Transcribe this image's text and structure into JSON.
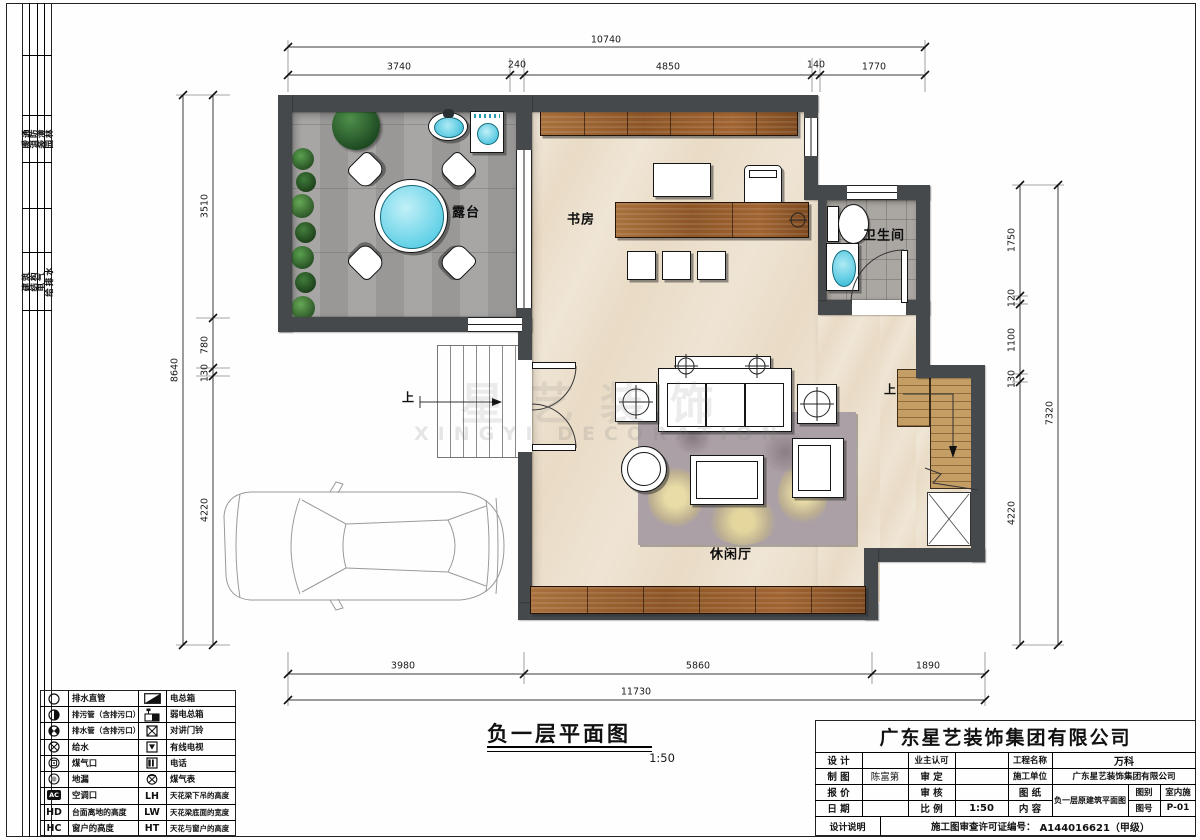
{
  "sidebar": {
    "group1": [
      "暖通",
      "消防",
      "装潢",
      "园林"
    ],
    "group2": [
      "建筑",
      "结构",
      "电气",
      "给排水"
    ]
  },
  "plan": {
    "rooms": {
      "terrace": "露台",
      "study": "书房",
      "bathroom": "卫生间",
      "lounge": "休闲厅"
    },
    "stair_up_left": "上",
    "stair_up_right": "上"
  },
  "watermark": {
    "cn": "星艺装饰",
    "en": "XINGYI DECORATION"
  },
  "dimensions": {
    "top": {
      "total": "10740",
      "segments": [
        "3740",
        "240",
        "4850",
        "140",
        "1770"
      ]
    },
    "bottom": {
      "total": "11730",
      "segments": [
        "3980",
        "5860",
        "1890"
      ]
    },
    "left": {
      "total": "8640",
      "segments": [
        "3510",
        "780",
        "130",
        "4220"
      ]
    },
    "right": {
      "total": "7320",
      "segments": [
        "1750",
        "120",
        "1100",
        "130",
        "4220"
      ]
    }
  },
  "plan_title": {
    "text": "负一层平面图",
    "scale": "1:50"
  },
  "legend": {
    "left": [
      {
        "label": "排水直管"
      },
      {
        "label": "排污管（含排污口）"
      },
      {
        "label": "排水管（含排污口）"
      },
      {
        "label": "给水"
      },
      {
        "label": "煤气口"
      },
      {
        "label": "地漏"
      },
      {
        "label": "空调口",
        "code": "AC"
      },
      {
        "label": "台面离地的高度",
        "code": "HD"
      },
      {
        "label": "窗户的高度",
        "code": "HC"
      }
    ],
    "right": [
      {
        "label": "电总箱"
      },
      {
        "label": "弱电总箱"
      },
      {
        "label": "对讲门铃"
      },
      {
        "label": "有线电视"
      },
      {
        "label": "电话"
      },
      {
        "label": "煤气表"
      },
      {
        "label": "天花梁下吊的高度",
        "code": "LH"
      },
      {
        "label": "天花梁底面的宽度",
        "code": "LW"
      },
      {
        "label": "天花与窗户的高度",
        "code": "HT"
      }
    ]
  },
  "title_block": {
    "company": "广东星艺装饰集团有限公司",
    "design_label": "设 计",
    "design_value": "",
    "drafting_label": "制 图",
    "drafting_value": "陈富第",
    "quote_label": "报 价",
    "quote_value": "",
    "date_label": "日 期",
    "date_value": "",
    "owner_label": "业主认可",
    "owner_value": "",
    "approve_label": "审 定",
    "approve_value": "",
    "review_label": "审 核",
    "review_value": "",
    "scale_label": "比 例",
    "scale_value": "1:50",
    "project_label": "工程名称",
    "project_value": "万科",
    "contractor_label": "施工单位",
    "contractor_value": "广东星艺装饰集团有限公司",
    "sheet_label": "图 纸",
    "content_label": "内 容",
    "content_value": "负一层原建筑平面图",
    "category_label": "图别",
    "category_value": "室内施",
    "number_label": "图号",
    "number_value": "P-01",
    "note_label": "设计说明",
    "permit_label": "施工图审查许可证编号：",
    "permit_value": "A144016621（甲级）"
  },
  "colors": {
    "wall": "#45494c",
    "accent_cyan": "#66d4e8",
    "wood": "#9a6132",
    "floor": "#e9dbc5"
  }
}
